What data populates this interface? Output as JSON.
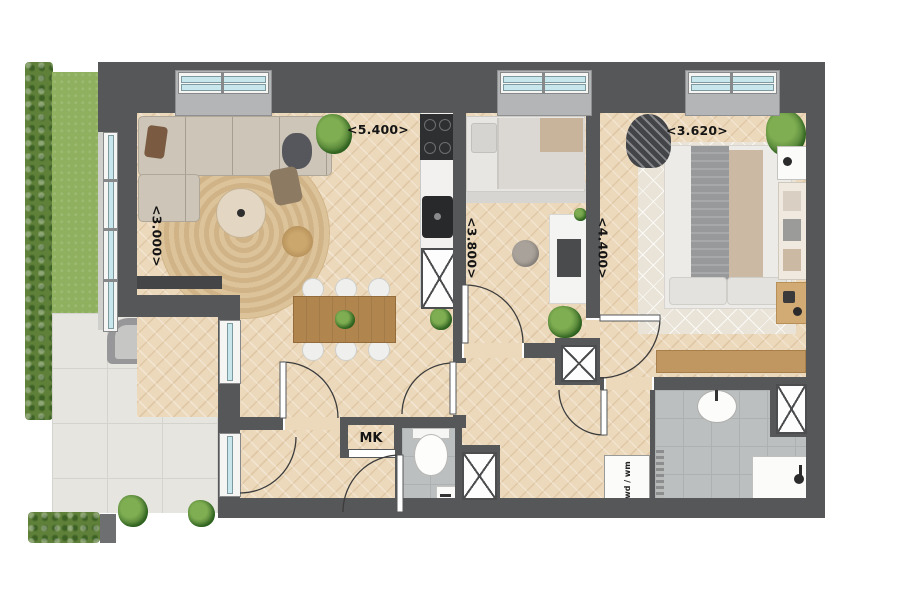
{
  "labels": {
    "living_width": "<5.400>",
    "living_depth": "<3.000>",
    "bedroom1_depth": "<3.800>",
    "bedroom2_depth": "<4.400>",
    "bedroom2_width": "<3.620>",
    "meter_cupboard": "MK",
    "washer_dryer": "wd / wm"
  },
  "colors": {
    "wall": "#565759",
    "wood_floor": "#ecd9bb",
    "patio_tile": "#e7e5e0",
    "wet_room_tile": "#bcbfbf",
    "glass": "#c7e7ed",
    "grass": "#8fb05e",
    "hedge": "#5e8039"
  }
}
